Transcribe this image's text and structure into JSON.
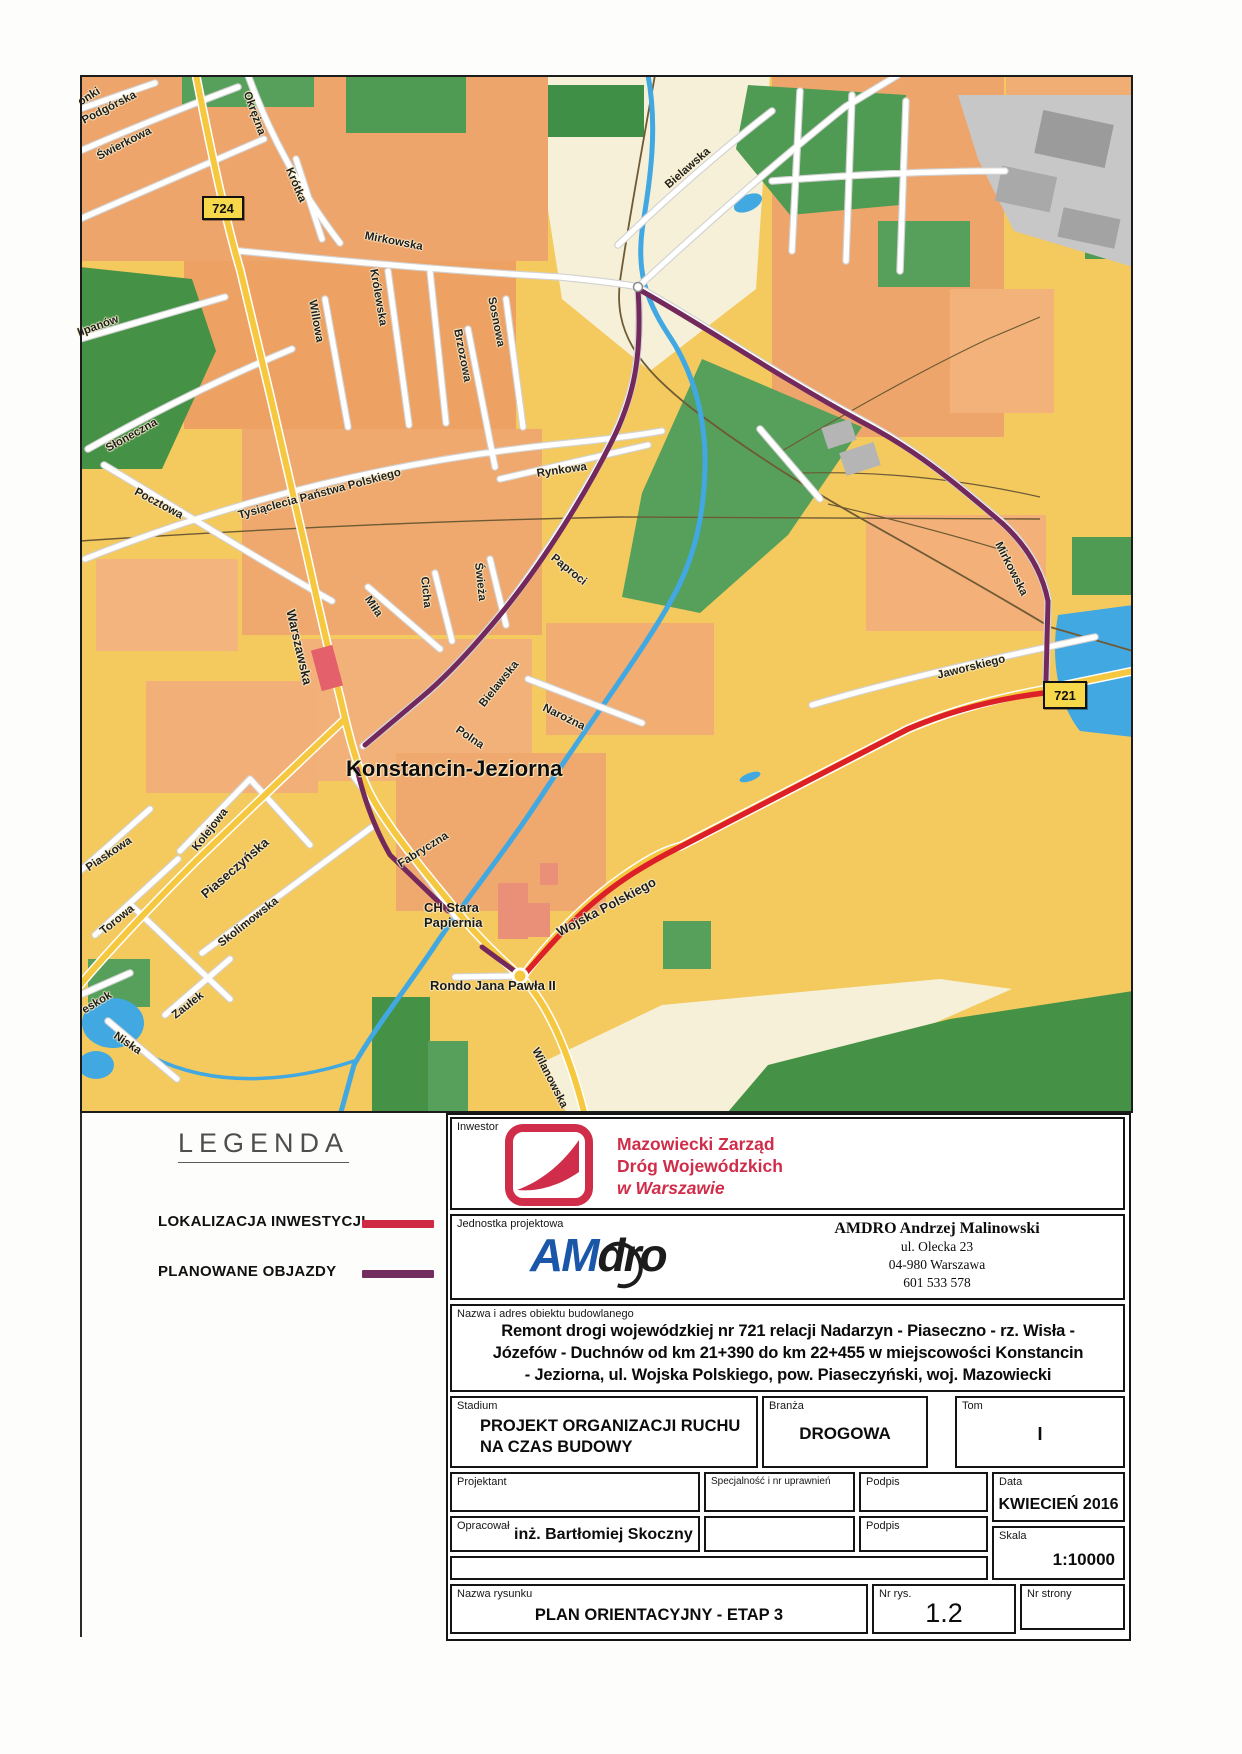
{
  "map": {
    "city": "Konstancin-Jeziorna",
    "mall": "CH Stara\nPapiernia",
    "roundabout": "Rondo Jana Pawła II",
    "badges": {
      "b724": "724",
      "b721": "721"
    },
    "streets": [
      {
        "text": "onki"
      },
      {
        "text": "Podgórska"
      },
      {
        "text": "Świerkowa"
      },
      {
        "text": "Okrężna"
      },
      {
        "text": "Krótka"
      },
      {
        "text": "Mirkowska"
      },
      {
        "text": "Królewska"
      },
      {
        "text": "Willowa"
      },
      {
        "text": "Brzozowa"
      },
      {
        "text": "Sosnowa"
      },
      {
        "text": "Bielawska"
      },
      {
        "text": "lipanów"
      },
      {
        "text": "Słoneczna"
      },
      {
        "text": "Pocztowa"
      },
      {
        "text": "Tysiąclecia Państwa Polskiego"
      },
      {
        "text": "Rynkowa"
      },
      {
        "text": "Paproci"
      },
      {
        "text": "Cicha"
      },
      {
        "text": "Miła"
      },
      {
        "text": "Świeża"
      },
      {
        "text": "Bielawska"
      },
      {
        "text": "Narożna"
      },
      {
        "text": "Warszawska"
      },
      {
        "text": "Polna"
      },
      {
        "text": "Piaskowa"
      },
      {
        "text": "Torowa"
      },
      {
        "text": "Kolejowa"
      },
      {
        "text": "Piaseczyńska"
      },
      {
        "text": "Skolimowska"
      },
      {
        "text": "Fabryczna"
      },
      {
        "text": "Zaułek"
      },
      {
        "text": "eskok"
      },
      {
        "text": "Niska"
      },
      {
        "text": "Wojska Polskiego"
      },
      {
        "text": "Jaworskiego"
      },
      {
        "text": "Mirkowska"
      },
      {
        "text": "Wilanowska"
      }
    ]
  },
  "legend": {
    "title": "LEGENDA",
    "items": [
      {
        "label": "LOKALIZACJA INWESTYCJI",
        "color": "#cf2944",
        "meaning": "investment-location-line"
      },
      {
        "label": "PLANOWANE OBJAZDY",
        "color": "#722e5e",
        "meaning": "planned-detours-line"
      }
    ]
  },
  "title_block": {
    "inwestor_label": "Inwestor",
    "inwestor_line1": "Mazowiecki Zarząd",
    "inwestor_line2": "Dróg Wojewódzkich",
    "inwestor_line3": "w Warszawie",
    "jednostka_label": "Jednostka projektowa",
    "logo_am": "AM",
    "logo_dro": "dro",
    "jednostka_name": "AMDRO Andrzej Malinowski",
    "jednostka_addr1": "ul. Olecka 23",
    "jednostka_addr2": "04-980  Warszawa",
    "jednostka_phone": "601 533 578",
    "nazwa_label": "Nazwa i adres obiektu budowlanego",
    "nazwa_line1": "Remont drogi wojewódzkiej nr 721 relacji Nadarzyn - Piaseczno - rz. Wisła -",
    "nazwa_line2": "Józefów - Duchnów od km 21+390 do km 22+455 w miejscowości Konstancin",
    "nazwa_line3": "- Jeziorna, ul. Wojska Polskiego, pow. Piaseczyński, woj. Mazowiecki",
    "stadium_label": "Stadium",
    "stadium_value": "PROJEKT ORGANIZACJI RUCHU NA CZAS BUDOWY",
    "branza_label": "Branża",
    "branza_value": "DROGOWA",
    "tom_label": "Tom",
    "tom_value": "I",
    "projektant_label": "Projektant",
    "opracowal_label": "Opracował",
    "opracowal_value": "inż. Bartłomiej Skoczny",
    "specjalnosc_label": "Specjalność i nr uprawnień",
    "podpis_label_1": "Podpis",
    "podpis_label_2": "Podpis",
    "data_label": "Data",
    "data_value": "KWIECIEŃ 2016",
    "skala_label": "Skala",
    "skala_value": "1:10000",
    "nazwa_rysunku_label": "Nazwa rysunku",
    "nazwa_rysunku_value": "PLAN ORIENTACYJNY - ETAP 3",
    "nr_rys_label": "Nr rys.",
    "nr_rys_value": "1.2",
    "nr_strony_label": "Nr strony"
  },
  "colors": {
    "map_background": "#f4ca5e",
    "built_up": "#eea56c",
    "fields_cream": "#f5f0d7",
    "forest_green": "#4f9b53",
    "water_blue": "#41a8e1",
    "investment_red": "#dd2027",
    "detour_purple": "#74295c",
    "logo_red": "#d02d4a",
    "logo_blue": "#1a57a8"
  }
}
